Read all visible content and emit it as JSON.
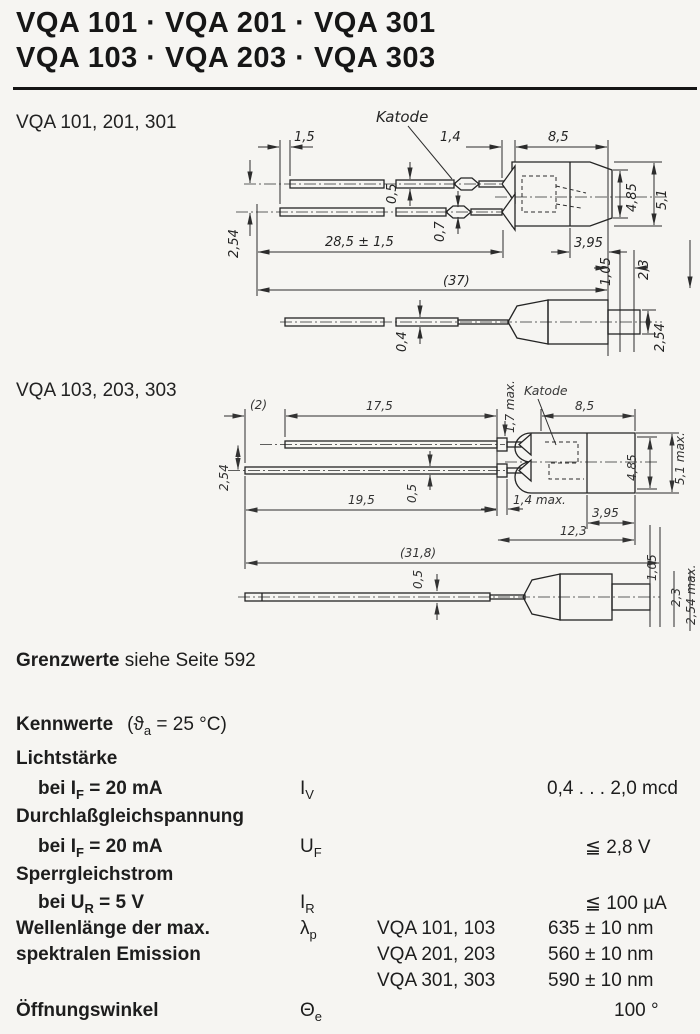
{
  "title": {
    "line1": "VQA 101 · VQA 201 · VQA 301",
    "line2": "VQA 103 · VQA 203 · VQA 303"
  },
  "drawing1": {
    "label": "VQA 101, 201, 301",
    "katode_label": "Katode",
    "dims": {
      "lead_offset": "1,5",
      "flange": "1,4",
      "body_length": "8,5",
      "lead_thickness_top": "0,5",
      "lead_thickness_bottom": "0,7",
      "lead_length": "28,5 ± 1,5",
      "total_length": "(37)",
      "lead_pitch": "2,54",
      "body_dia_inner": "4,85",
      "body_dia_outer": "5,1",
      "front_length": "3,95",
      "standoff_1": "1,05",
      "standoff_2": "2,3",
      "side_lead_thickness": "0,4",
      "side_height": "2,54"
    }
  },
  "drawing2": {
    "label": "VQA 103, 203, 303",
    "katode_label": "Katode",
    "dims": {
      "lead_offset": "(2)",
      "lead_segment": "17,5",
      "tip_length": "1,7 max.",
      "body_length": "8,5",
      "lead_pitch": "2,54",
      "lead_length": "19,5",
      "lead_thickness": "0,5",
      "collar_length": "1,4 max.",
      "front_length": "3,95",
      "body_total": "12,3",
      "total_length": "(31,8)",
      "body_dia_inner": "4,85",
      "body_dia_outer": "5,1 max.",
      "side_lead_thickness": "0,5",
      "standoff_1": "1,05",
      "standoff_2": "2,3",
      "side_height": "2,54 max."
    }
  },
  "limits": {
    "bold": "Grenzwerte",
    "rest": " siehe Seite 592"
  },
  "characteristics": {
    "heading": {
      "bold": "Kennwerte",
      "paren_pre": "(ϑ",
      "paren_sub": "a",
      "paren_post": " = 25 °C)"
    },
    "rows": [
      {
        "name": "Lichtstärke",
        "cond_pre": "bei I",
        "cond_sub": "F",
        "cond_post": " = 20 mA",
        "sym_pre": "I",
        "sym_sub": "V",
        "value": "0,4 . . . 2,0 mcd"
      },
      {
        "name": "Durchlaßgleichspannung",
        "cond_pre": "bei I",
        "cond_sub": "F",
        "cond_post": " = 20 mA",
        "sym_pre": "U",
        "sym_sub": "F",
        "value": "≦ 2,8 V"
      },
      {
        "name": "Sperrgleichstrom",
        "cond_pre": "bei U",
        "cond_sub": "R",
        "cond_post": " = 5 V",
        "sym_pre": "I",
        "sym_sub": "R",
        "value": "≦ 100 µA"
      },
      {
        "name_line1": "Wellenlänge der max.",
        "name_line2": "spektralen Emission",
        "sym_pre": "λ",
        "sym_sub": "p",
        "variants": [
          {
            "type": "VQA 101, 103",
            "value": "635 ± 10 nm"
          },
          {
            "type": "VQA 201, 203",
            "value": "560 ± 10 nm"
          },
          {
            "type": "VQA 301, 303",
            "value": "590 ± 10 nm"
          }
        ]
      },
      {
        "name": "Öffnungswinkel",
        "sym_pre": "Θ",
        "sym_sub": "e",
        "value": "100 °"
      }
    ]
  }
}
